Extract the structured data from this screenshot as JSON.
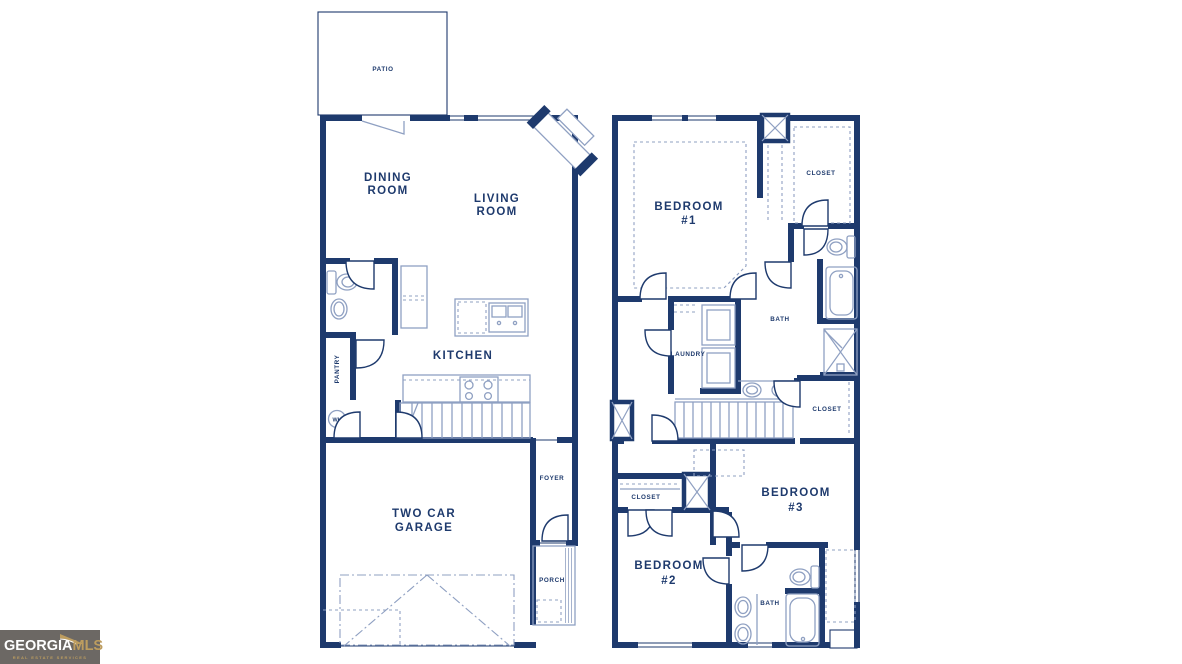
{
  "colors": {
    "wall": "#1e3a6d",
    "fixture": "#8fa0c2",
    "label": "#1e3a6d",
    "logo_bg": "#6c6864",
    "logo_gold": "#bd9d5f",
    "logo_white": "#ffffff"
  },
  "floor1": {
    "patio": "PATIO",
    "dining1": "DINING",
    "dining2": "ROOM",
    "living1": "LIVING",
    "living2": "ROOM",
    "kitchen": "KITCHEN",
    "pantry": "PANTRY",
    "water_heater": "WH",
    "foyer": "FOYER",
    "garage1": "TWO CAR",
    "garage2": "GARAGE",
    "porch": "PORCH"
  },
  "floor2": {
    "bedroom1_1": "BEDROOM",
    "bedroom1_2": "#1",
    "closet_top": "CLOSET",
    "bath_main": "BATH",
    "laundry": "LAUNDRY",
    "closet_mid": "CLOSET",
    "closet_lower": "CLOSET",
    "bedroom3_1": "BEDROOM",
    "bedroom3_2": "#3",
    "bedroom2_1": "BEDROOM",
    "bedroom2_2": "#2",
    "bath2": "BATH"
  },
  "logo": {
    "name_part1": "GEORGIA",
    "name_part2": "MLS",
    "tagline": "REAL ESTATE SERVICES"
  }
}
